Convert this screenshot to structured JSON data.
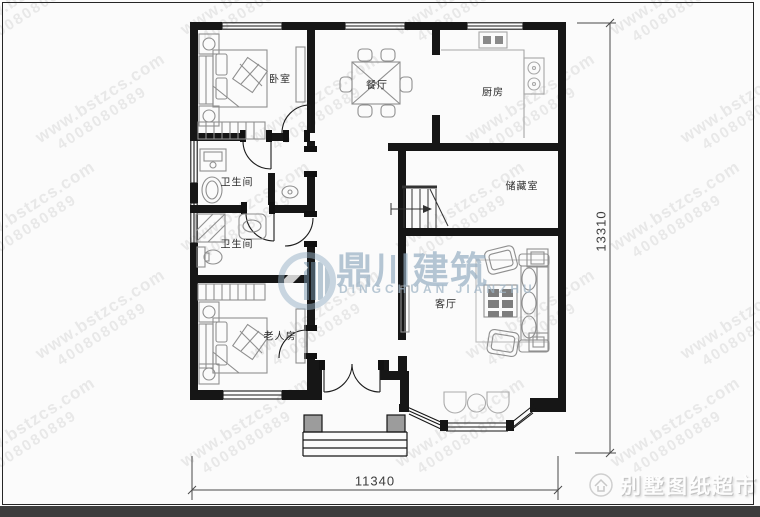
{
  "watermark": {
    "site": "www.bstzcs.com",
    "phone": "4008080889"
  },
  "logo": {
    "name_cn": "鼎川建筑",
    "name_en": "DINGCHUAN JIANZHU"
  },
  "brand_footer": {
    "text": "别墅图纸超市"
  },
  "rooms": [
    {
      "id": "bedroom",
      "label": "卧室"
    },
    {
      "id": "dining",
      "label": "餐厅"
    },
    {
      "id": "kitchen",
      "label": "厨房"
    },
    {
      "id": "bathroom-upper",
      "label": "卫生间"
    },
    {
      "id": "bathroom-lower",
      "label": "卫生间"
    },
    {
      "id": "storage",
      "label": "储藏室"
    },
    {
      "id": "living",
      "label": "客厅"
    },
    {
      "id": "elder-room",
      "label": "老人房"
    }
  ],
  "dimensions": {
    "width_mm": "11340",
    "height_mm": "13310"
  },
  "colors": {
    "wall": "#161616",
    "furniture_gray": "#8f8f8f",
    "logo_blue": "#96b1c5",
    "footer_bar": "#3d3d3d"
  }
}
